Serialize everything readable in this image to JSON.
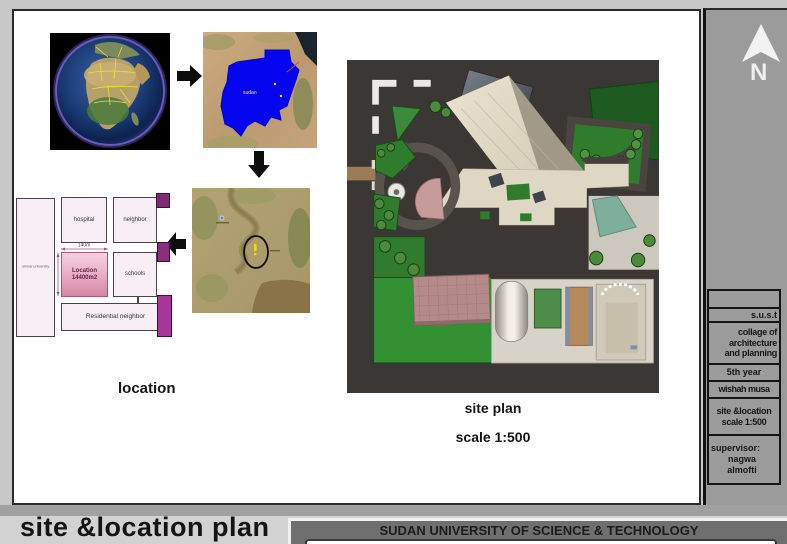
{
  "flow": {
    "sudan_label": "sudan"
  },
  "location_diagram": {
    "caption": "location",
    "university": "sinnar university",
    "hospital": "hospital",
    "neighbor": "neighbor",
    "location_title": "Location\n14400m2",
    "dimension_width": "140m",
    "schools": "schools",
    "residential": "Residential neighbor"
  },
  "site_plan": {
    "caption": "site plan",
    "scale": "scale 1:500"
  },
  "sidebar": {
    "north_letter": "N",
    "rows": [
      {
        "text": ""
      },
      {
        "text": "s.u.s.t"
      },
      {
        "text": "collage of\narchitecture\nand planning"
      },
      {
        "text": "5th year"
      },
      {
        "text": "wishah musa"
      },
      {
        "text": "site &location\nscale 1:500"
      },
      {
        "text": "supervisor:",
        "name": "nagwa\nalmofti"
      }
    ]
  },
  "footer": {
    "title": "site &location plan",
    "university": "SUDAN UNIVERSITY OF SCIENCE & TECHNOLOGY"
  },
  "colors": {
    "sudan_fill": "#0505f0",
    "accent_magenta": "#a8359a",
    "lawn_green": "#2f8c2f",
    "siteplan_bg": "#3b3734",
    "sidebar_gray": "#9b9b9b"
  }
}
